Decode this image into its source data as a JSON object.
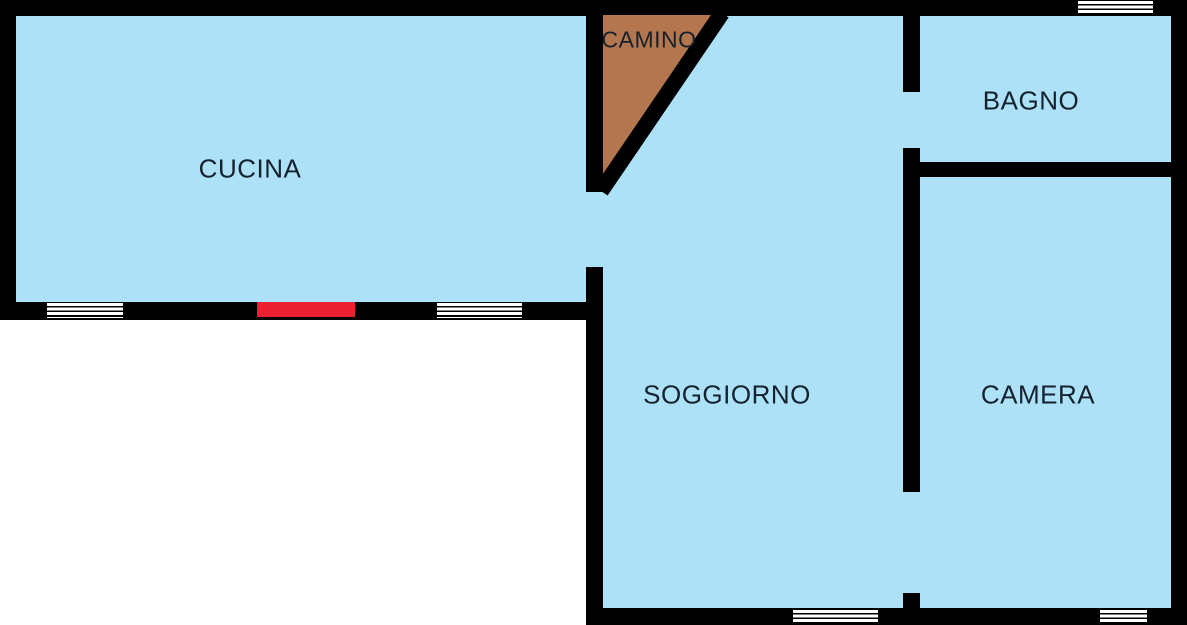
{
  "floorplan": {
    "title": "apartment-floor-plan",
    "rooms": [
      {
        "id": "cucina",
        "label": "CUCINA"
      },
      {
        "id": "camino",
        "label": "CAMINO"
      },
      {
        "id": "bagno",
        "label": "BAGNO"
      },
      {
        "id": "soggiorno",
        "label": "SOGGIORNO"
      },
      {
        "id": "camera",
        "label": "CAMERA"
      }
    ],
    "features": {
      "doors_red": 1,
      "windows": 5,
      "fireplace": "triangular, top center"
    },
    "colors": {
      "floor_fill": "#ace1f7",
      "wall": "#000000",
      "fireplace_fill": "#b3764e",
      "door": "#e8202f",
      "window": "#ffffff",
      "label_text": "#15212d",
      "background": "#ffffff"
    }
  }
}
